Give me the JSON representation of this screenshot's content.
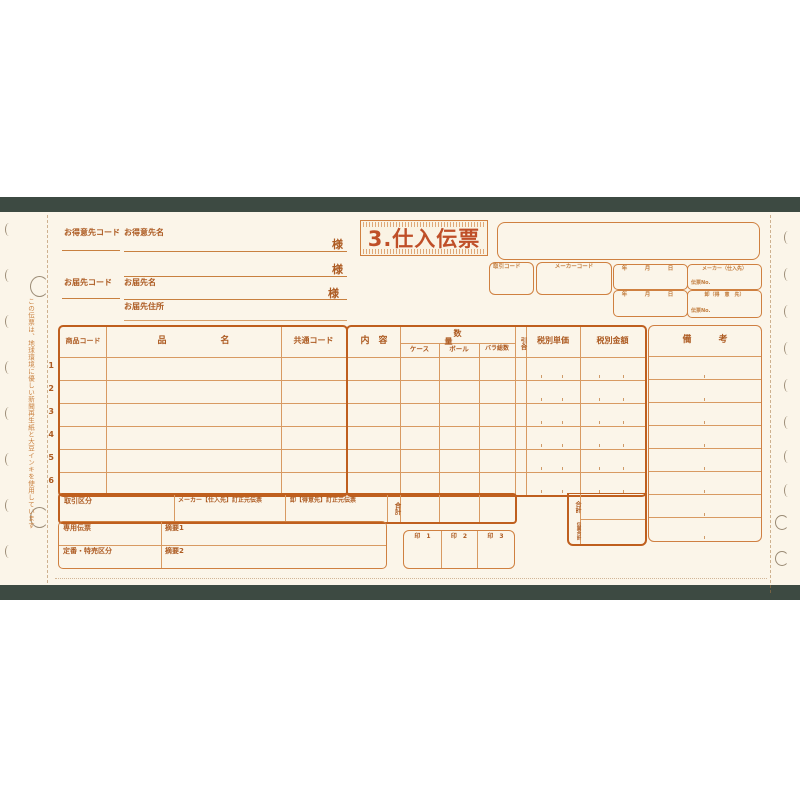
{
  "colors": {
    "accent": "#bf5f1e",
    "grid": "#d89a62",
    "title": "#bf4f28",
    "band": "#3d4a42",
    "sheet": "#fbf5e9"
  },
  "side_notes": {
    "eco": "この伝票は、地球環境に優しい新聞再生紙と大豆インキを使用しています"
  },
  "header": {
    "title": "3.仕入伝票",
    "customer_code": "お得意先コード",
    "customer_name": "お得意先名",
    "sama1": "様",
    "sama2": "様",
    "sama3": "様",
    "delivery_code": "お届先コード",
    "delivery_name": "お届先名",
    "delivery_address": "お届先住所",
    "transaction_code": "取引コード",
    "maker_code": "メーカーコード",
    "date_row1": "年　月　日",
    "date_row2": "年　月　日",
    "maker_party": "メーカー（仕入先）",
    "maker_slip_no": "伝票No.",
    "wholesaler_party": "卸（得　意　先）",
    "wholesaler_slip_no": "伝票No."
  },
  "table": {
    "headers": {
      "product_code": "商品コード",
      "item_name": "品　　　　　　名",
      "common_code": "共通コード",
      "contents": "内　容",
      "quantity": "数　　量",
      "case": "ケース",
      "ball": "ボール",
      "bulk_total": "バラ総数",
      "hikiai": "引合",
      "unit_price_ex_tax": "税別単価",
      "amount_ex_tax": "税別金額",
      "remarks": "備　　　考"
    },
    "row_numbers": [
      "1",
      "2",
      "3",
      "4",
      "5",
      "6"
    ]
  },
  "footer": {
    "transaction_class": "取引区分",
    "maker_correction": "メーカー【仕入先】訂正元伝票",
    "wholesaler_correction": "卸【得意先】訂正元伝票",
    "qty_total": "合計",
    "amount_total": "合計",
    "slip_total": "伝票合計",
    "dedicated_slip": "専用伝票",
    "summary1": "摘要1",
    "class_regular_special": "定番・特売区分",
    "summary2": "摘要2",
    "stamps": [
      "印　1",
      "印　2",
      "印　3"
    ]
  }
}
